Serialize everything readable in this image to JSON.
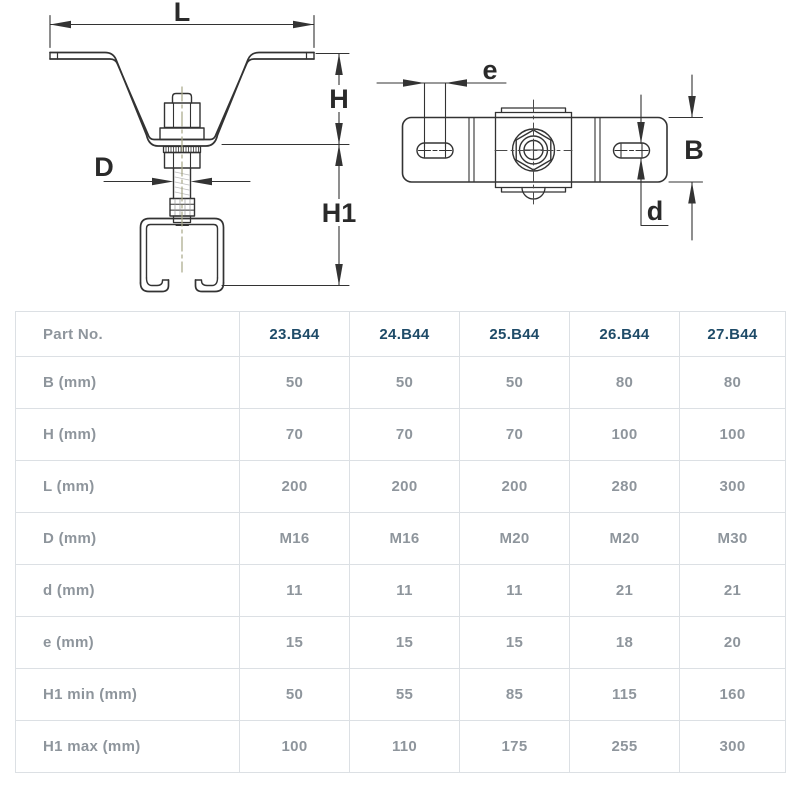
{
  "drawing": {
    "front_view_labels": {
      "L": "L",
      "H": "H",
      "H1": "H1",
      "D": "D"
    },
    "top_view_labels": {
      "e": "e",
      "B": "B",
      "d": "d"
    }
  },
  "table": {
    "header": {
      "label": "Part No.",
      "columns": [
        "23.B44",
        "24.B44",
        "25.B44",
        "26.B44",
        "27.B44"
      ]
    },
    "rows": [
      {
        "label": "B (mm)",
        "values": [
          "50",
          "50",
          "50",
          "80",
          "80"
        ]
      },
      {
        "label": "H (mm)",
        "values": [
          "70",
          "70",
          "70",
          "100",
          "100"
        ]
      },
      {
        "label": "L (mm)",
        "values": [
          "200",
          "200",
          "200",
          "280",
          "300"
        ]
      },
      {
        "label": "D (mm)",
        "values": [
          "M16",
          "M16",
          "M20",
          "M20",
          "M30"
        ]
      },
      {
        "label": "d (mm)",
        "values": [
          "11",
          "11",
          "11",
          "21",
          "21"
        ]
      },
      {
        "label": "e (mm)",
        "values": [
          "15",
          "15",
          "15",
          "18",
          "20"
        ]
      },
      {
        "label": "H1 min (mm)",
        "values": [
          "50",
          "55",
          "85",
          "115",
          "160"
        ]
      },
      {
        "label": "H1 max (mm)",
        "values": [
          "100",
          "110",
          "175",
          "255",
          "300"
        ]
      }
    ]
  },
  "colors": {
    "header_code_text": "#1e4b68",
    "table_text": "#8e959c",
    "table_border": "#dce0e4",
    "line_color": "#333333",
    "centerline_color": "#a6a687"
  }
}
